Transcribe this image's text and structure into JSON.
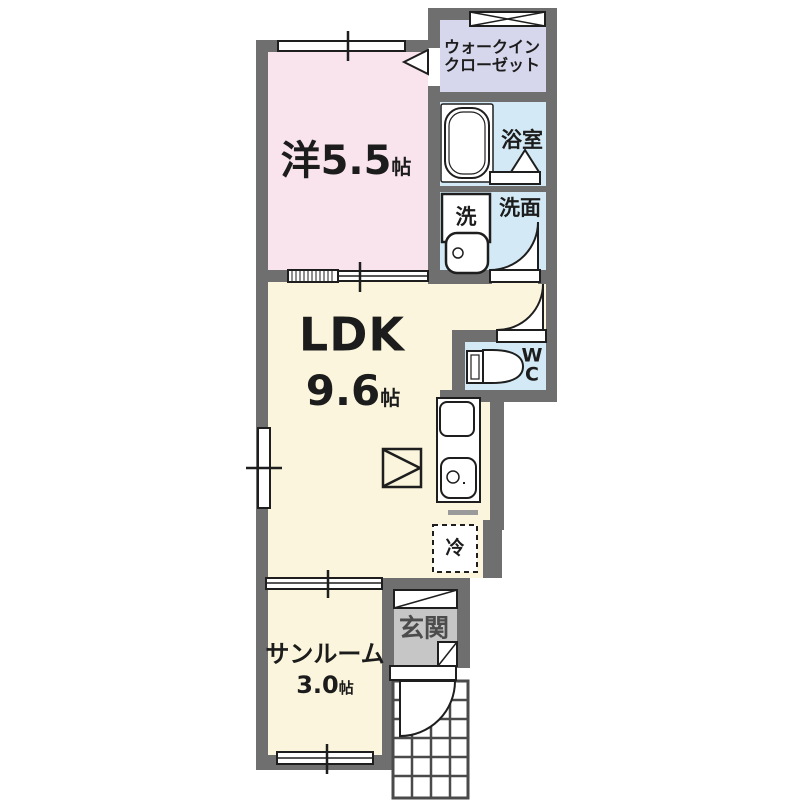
{
  "colors": {
    "wall": "#6f6f6f",
    "bedroom": "#f9e3ed",
    "closet": "#d6d6ec",
    "water": "#d3eaf6",
    "ldk": "#faf5dc",
    "entrance": "#c6c6c6",
    "line": "#1e1e1e",
    "tile_line": "#4a4a4a",
    "fixture_fill": "#ffffff"
  },
  "rooms": {
    "bedroom": {
      "prefix": "洋",
      "size": "5.5",
      "unit": "帖"
    },
    "closet": {
      "line1": "ウォークイン",
      "line2": "クローゼット"
    },
    "bathroom": {
      "label": "浴室"
    },
    "laundry": {
      "label": "洗"
    },
    "washroom": {
      "label": "洗面"
    },
    "ldk": {
      "label": "LDK",
      "size": "9.6",
      "unit": "帖"
    },
    "wc": {
      "line1": "W",
      "line2": "C"
    },
    "fridge": {
      "label": "冷"
    },
    "sunroom": {
      "label": "サンルーム",
      "size": "3.0",
      "unit": "帖"
    },
    "entrance": {
      "label": "玄関"
    }
  }
}
